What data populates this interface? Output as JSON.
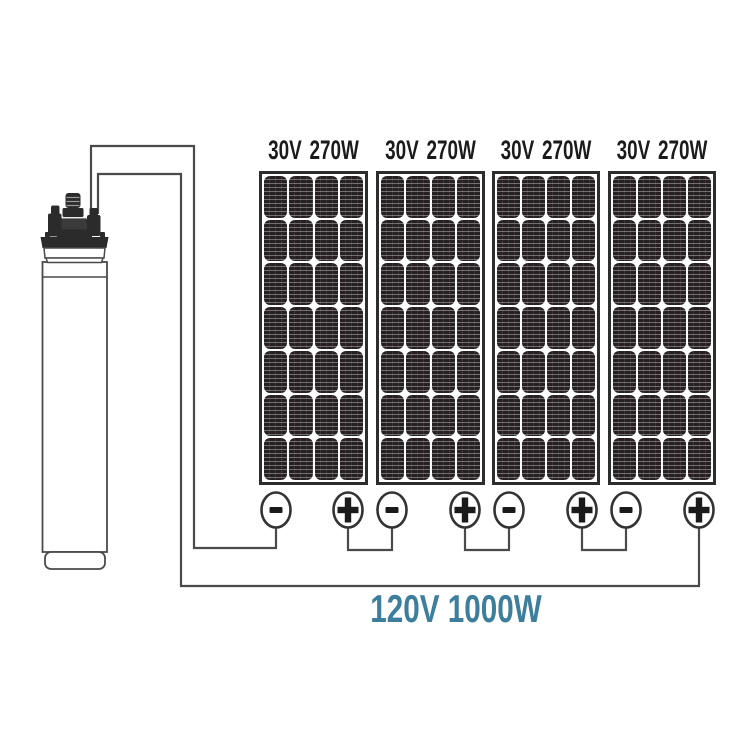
{
  "panels": [
    {
      "voltage": "30V",
      "power": "270W",
      "terminals": [
        "minus",
        "plus"
      ]
    },
    {
      "voltage": "30V",
      "power": "270W",
      "terminals": [
        "minus",
        "plus"
      ]
    },
    {
      "voltage": "30V",
      "power": "270W",
      "terminals": [
        "minus",
        "plus"
      ]
    },
    {
      "voltage": "30V",
      "power": "270W",
      "terminals": [
        "minus",
        "plus"
      ]
    }
  ],
  "system_output": {
    "label": "120V 1000W"
  },
  "icons": {
    "pump": "submersible-pump-icon",
    "terminal_minus": "minus-circle-icon",
    "terminal_plus": "plus-circle-icon"
  },
  "connections": [
    {
      "from": "pump-wire-a",
      "to": "panel-1-minus"
    },
    {
      "from": "panel-1-plus",
      "to": "panel-2-minus"
    },
    {
      "from": "panel-2-plus",
      "to": "panel-3-minus"
    },
    {
      "from": "panel-3-plus",
      "to": "panel-4-minus"
    },
    {
      "from": "panel-4-plus",
      "to": "pump-wire-b"
    }
  ],
  "colors": {
    "wire": "#4a4a4a",
    "panel_frame": "#2d2d2d",
    "cell_dark": "#262022",
    "terminal_stroke": "#333333",
    "pump_dark": "#2b2b2b",
    "output_text": "#3d7e9c",
    "label_text": "#1b1b1b",
    "background": "#ffffff"
  }
}
